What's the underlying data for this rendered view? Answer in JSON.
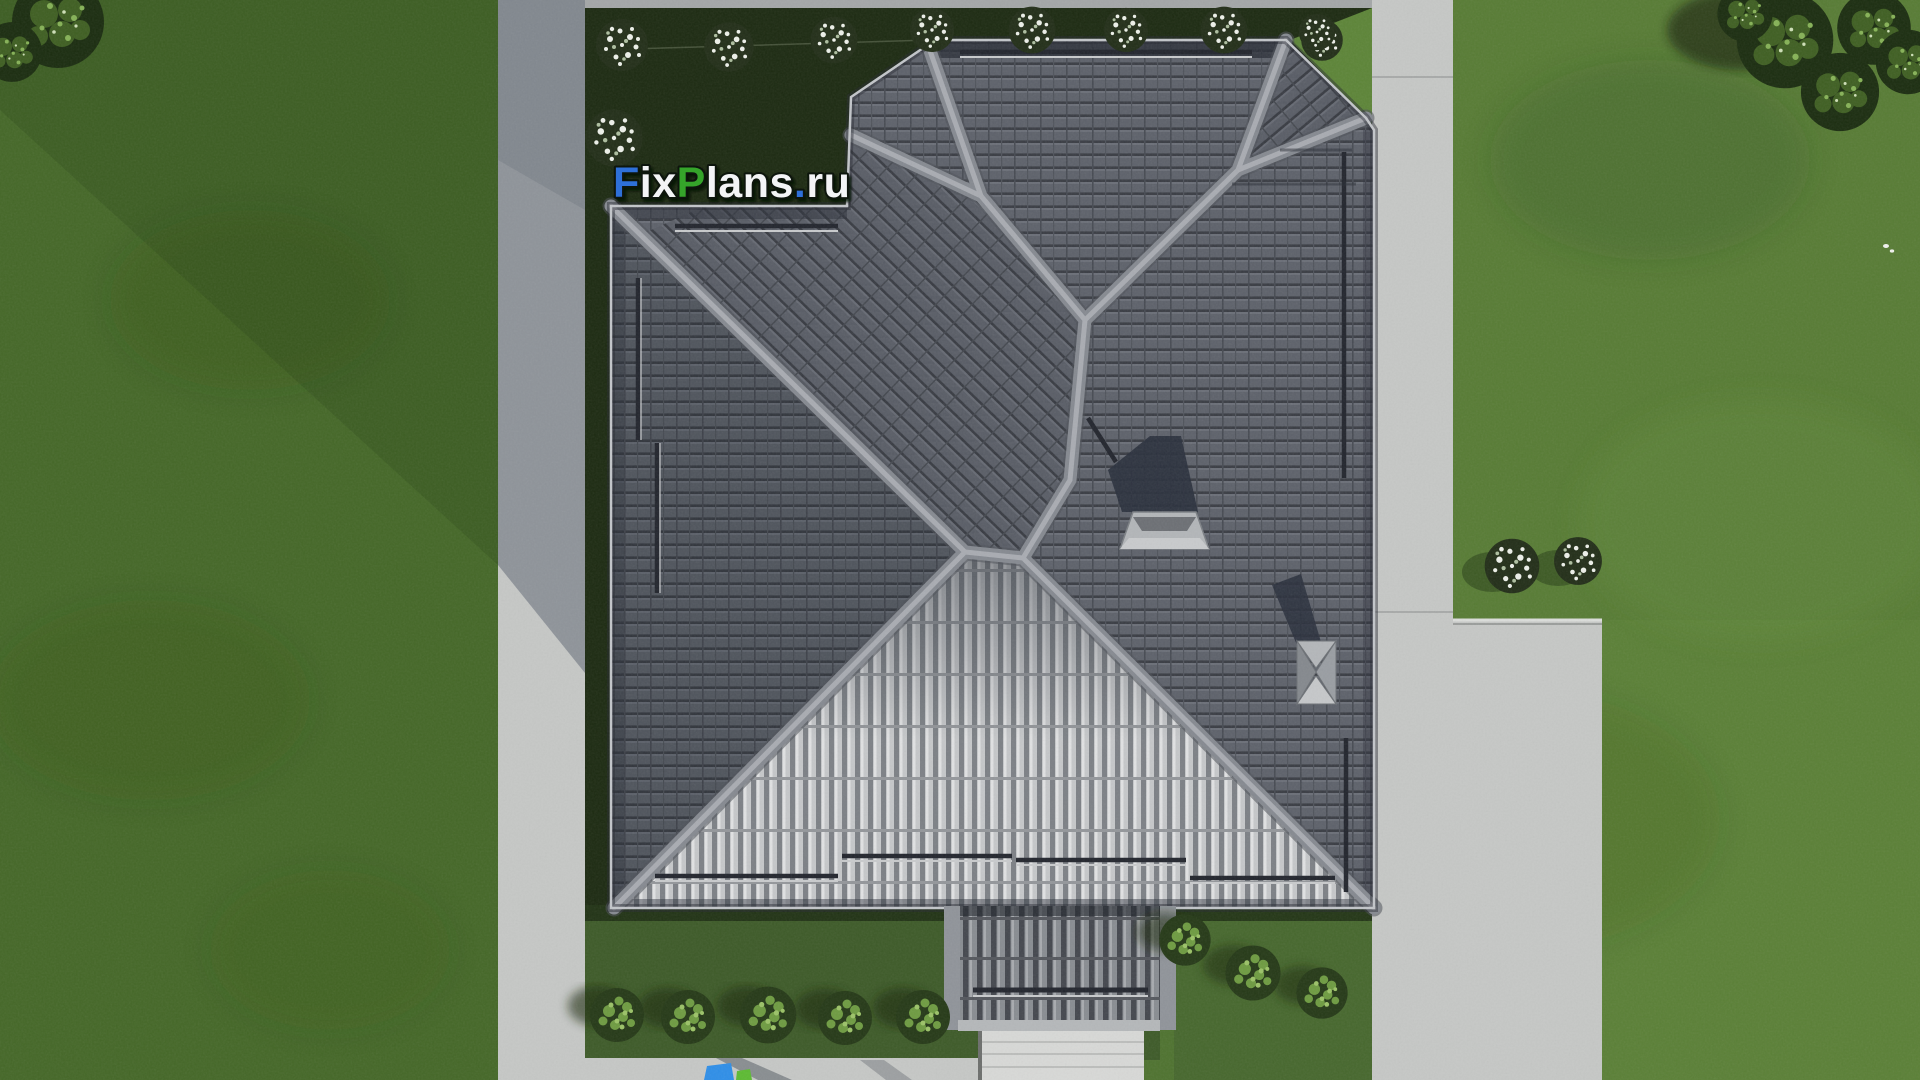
{
  "watermark": {
    "text": "FixPlans.ru",
    "segments": [
      {
        "text": "F",
        "color": "#2e6fd8"
      },
      {
        "text": "ix",
        "color": "#f3f4f6"
      },
      {
        "text": "P",
        "color": "#35a52c"
      },
      {
        "text": "lans",
        "color": "#f3f4f6"
      },
      {
        "text": ".",
        "color": "#2e6fd8"
      },
      {
        "text": "ru",
        "color": "#f3f4f6"
      }
    ],
    "outline_color": "#0d120a"
  },
  "watermark_fragment": {
    "blue": "#2f8fe8",
    "green": "#5dbb33"
  },
  "palette": {
    "grass": "#4f7330",
    "grass_left": "#486a2c",
    "lawn_bright": "#5d8538",
    "yard_dark": "#1d2b12",
    "yard_mid": "#3e5b29",
    "yard_mid_right": "#47682e",
    "concrete": "#c6c8c6",
    "concrete_shadow": "#7b828e",
    "top_strip": "#a4a7a8",
    "roof_dark": "#5e626b",
    "roof_gap": "#3a3d44",
    "roof_rib_light": "#c7c9cb",
    "ridge": "#868a91",
    "shadow_navy": "#2b313e",
    "stone": "#d8d9d7",
    "porch_rib": "#878b90"
  }
}
